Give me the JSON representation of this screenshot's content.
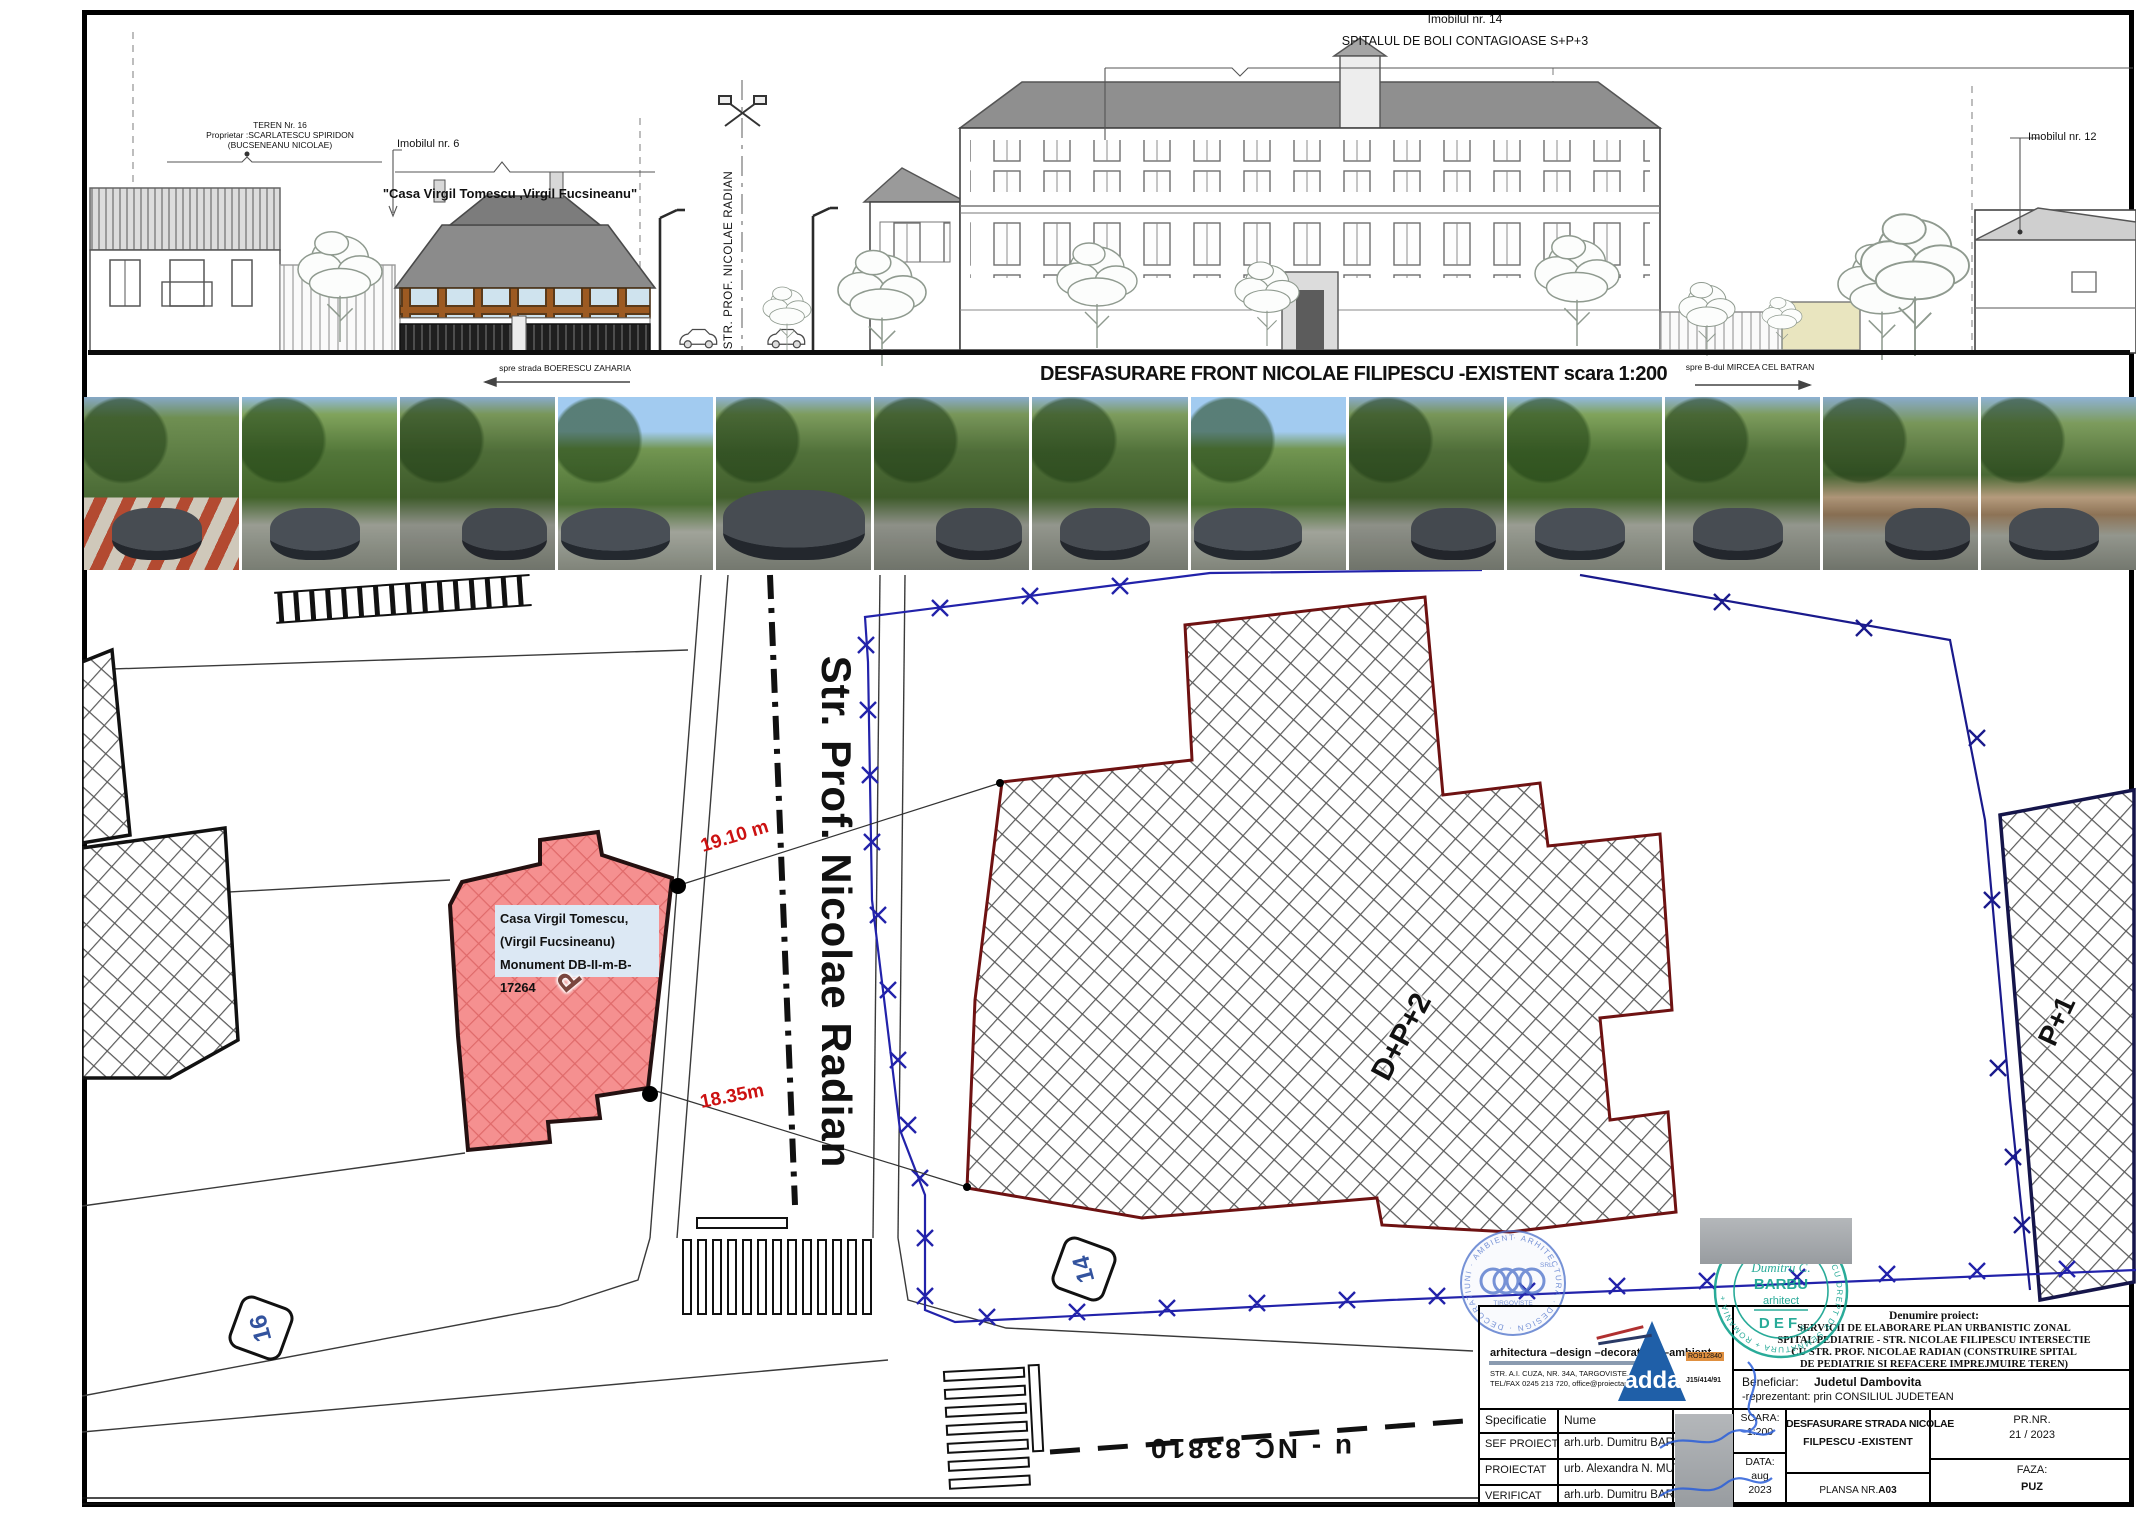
{
  "sheet": {
    "bg": "#ffffff",
    "frame_color": "#000000",
    "accent_red_fill": "#f59090",
    "dim_red": "#cc1111",
    "boundary_blue": "#2222aa",
    "stamp_teal": "#12a28e",
    "stamp_blue": "#5577cc",
    "logo_blue": "#1f5fa8"
  },
  "elevation": {
    "teren_line1": "TEREN Nr. 16",
    "teren_line2": "Proprietar :SCARLATESCU SPIRIDON",
    "teren_line3": "(BUCSENEANU NICOLAE)",
    "imobil6_label": "Imobilul nr. 6",
    "casa_label": "\"Casa Virgil Tomescu ,Virgil Fucsineanu\"",
    "street_sign": "STR. PROF. NICOLAE RADIAN",
    "imobil14_label": "Imobilul nr. 14",
    "spital_label": "SPITALUL DE BOLI CONTAGIOASE   S+P+3",
    "imobil12_label": "Imobilul nr. 12",
    "dir_left": "spre strada BOERESCU ZAHARIA",
    "band_title": "DESFASURARE FRONT NICOLAE FILIPESCU -EXISTENT scara 1:200",
    "dir_right": "spre B-dul  MIRCEA CEL BATRAN"
  },
  "photos": {
    "count": 13,
    "description": "street-level photographs of the existing Nicolae Filipescu street front"
  },
  "plan": {
    "street_name": "Str. Prof. Nicolae Radian",
    "monument_line1": "Casa Virgil Tomescu,",
    "monument_line2": "(Virgil Fucsineanu)",
    "monument_line3": "Monument DB-II-m-B-17264",
    "dim_19": "19.10 m",
    "dim_18": "18.35m",
    "regime_main": "D+P+2",
    "regime_right": "P+1",
    "house_regime": "P",
    "plate_16": "16",
    "plate_14": "14",
    "road_ref": "u - NC 83810"
  },
  "stamps": {
    "adda_ring_text": "· ARHITECTURA · DESIGN · DECORATIUNI · AMBIENT ",
    "adda_center_srl": "SRL",
    "adda_center_city": "TIRGOVISTE",
    "arch_ring_text": "SPECIALIST CU DREPT DE SEMNATURA  +  ROMANIA  +",
    "arch_name1": "Dumitru C.",
    "arch_name2": "BARBU",
    "arch_role": "arhitect",
    "arch_code": "D E F",
    "arch_code_sub": "6"
  },
  "titleblock": {
    "company_name": "arhitectura –design –decoratiuni –ambient",
    "company_addr1": "STR. A.I. CUZA, NR. 34A, TARGOVISTE, DAMBOVITA",
    "company_addr2": "TEL/FAX 0245 213 720, office@proiectareadda.ro",
    "logo_text": "adda",
    "reg1": "RO912840",
    "reg2": "J15/414/91",
    "denumire_label": "Denumire proiect:",
    "project_line1": "SERVICII DE ELABORARE PLAN URBANISTIC ZONAL",
    "project_line2": "SPITAL PEDIATRIE - STR. NICOLAE FILIPESCU INTERSECTIE",
    "project_line3": "CU STR. PROF. NICOLAE RADIAN (CONSTRUIRE SPITAL",
    "project_line4": "DE PEDIATRIE SI REFACERE IMPREJMUIRE TEREN)",
    "beneficiar_label": "Beneficiar:",
    "beneficiar_name": "Judetul Dambovita",
    "beneficiar_rep": "-reprezentant: prin CONSILIUL JUDETEAN",
    "col_specificatie": "Specificatie",
    "col_nume": "Nume",
    "rows": [
      {
        "spec": "SEF PROIECT",
        "nume": "arh.urb. Dumitru BARBU"
      },
      {
        "spec": "PROIECTAT",
        "nume": "urb. Alexandra N. MUTU"
      },
      {
        "spec": "VERIFICAT",
        "nume": "arh.urb. Dumitru BARBU"
      }
    ],
    "scara_label": "SCARA:",
    "scara_value": "1:200",
    "data_label": "DATA:",
    "data_value1": "aug",
    "data_value2": "2023",
    "plansa_title_line1": "DESFASURARE STRADA NICOLAE",
    "plansa_title_line2": "FILPESCU -EXISTENT",
    "plansa_label": "PLANSA NR.",
    "plansa_value": "A03",
    "pr_label": "PR.NR.",
    "pr_value": "21 / 2023",
    "faza_label": "FAZA:",
    "faza_value": "PUZ"
  }
}
